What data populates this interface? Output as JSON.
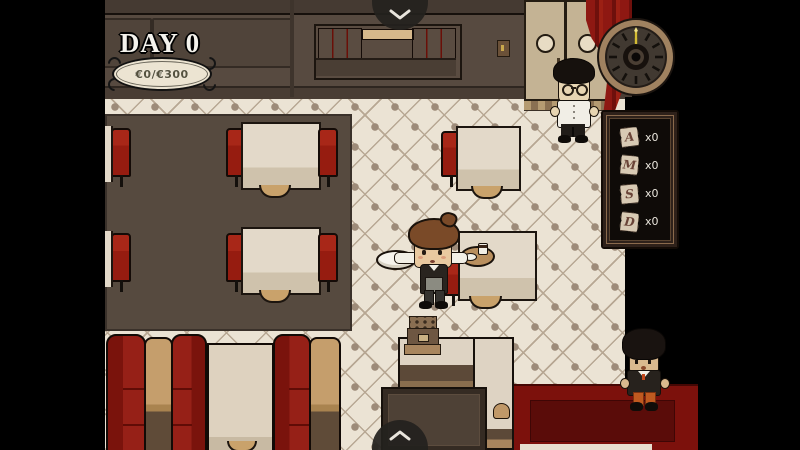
{
  "hud": {
    "day_label": "DAY 0",
    "money_label": "€0/€300"
  },
  "menu_board": {
    "items": [
      {
        "letter": "A",
        "count": "x0"
      },
      {
        "letter": "M",
        "count": "x0"
      },
      {
        "letter": "S",
        "count": "x0"
      },
      {
        "letter": "D",
        "count": "x0"
      }
    ]
  },
  "icons": {
    "top_tab": "chevron-down",
    "bottom_tab": "chevron-up",
    "clock_hand": "hand-at-12"
  },
  "colors": {
    "accent_red": "#8e1812",
    "wall_brown": "#574a40",
    "tile_cream": "#ebe3d4",
    "carpet_red": "#7c110c",
    "gold": "#d4bc34",
    "rug_brown": "#564a3f"
  }
}
